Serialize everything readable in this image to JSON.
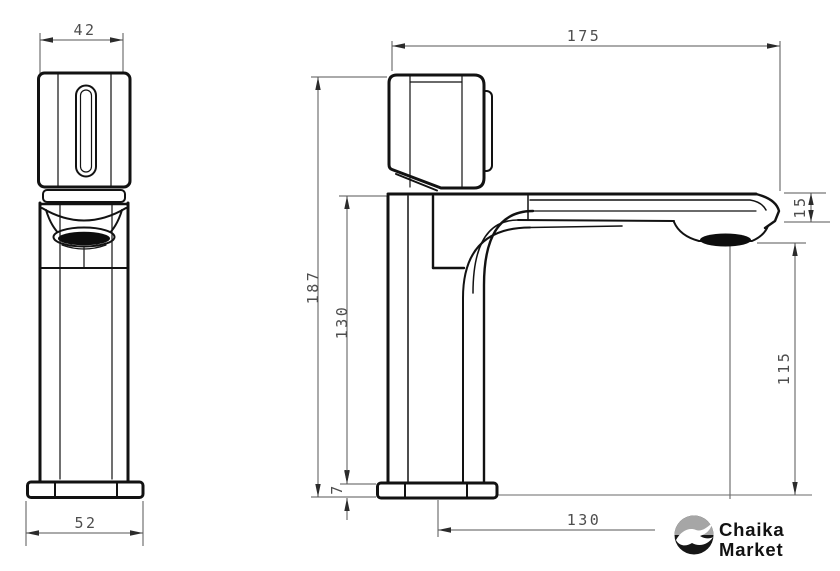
{
  "drawing": {
    "front_view": {
      "handle_width_mm": "42",
      "base_width_mm": "52"
    },
    "side_view": {
      "spout_reach_mm": "175",
      "total_height_mm": "187",
      "body_height_mm": "130",
      "spout_end_height_mm": "15",
      "outlet_clearance_mm": "115",
      "base_thickness_mm": "7",
      "outlet_offset_mm": "130"
    }
  },
  "logo": {
    "line1": "Chaika",
    "line2": "Market",
    "icon": "seagull-icon",
    "circle_color": "#161616",
    "sky_color": "#a6a6a6",
    "bird_color": "#ffffff",
    "text_color": "#121212"
  },
  "style": {
    "background": "#ffffff",
    "object_line_color": "#121212",
    "dimension_line_color": "#565656",
    "dimension_text_color": "#4d4d4d"
  }
}
